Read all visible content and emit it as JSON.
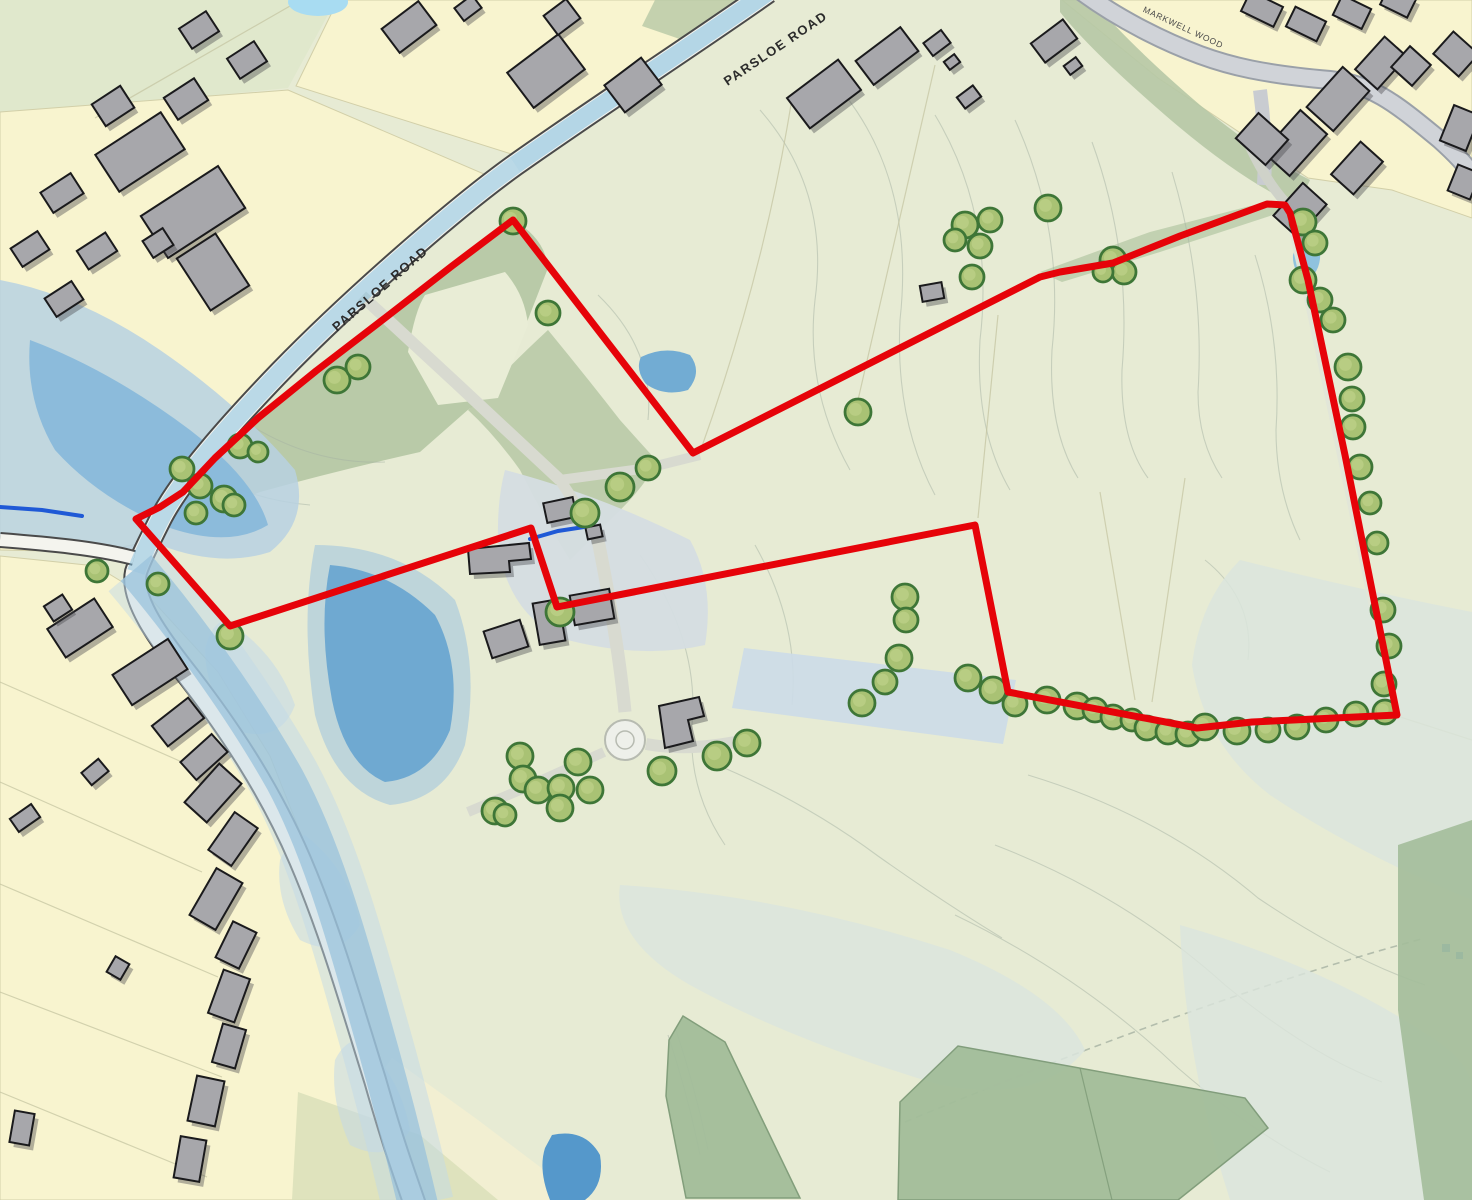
{
  "map": {
    "canvas": {
      "width": 1472,
      "height": 1200
    },
    "labels": [
      {
        "text": "PARSLOE ROAD",
        "x": 778,
        "y": 52,
        "rot": -34,
        "size": 13,
        "spacing": 1.5,
        "weight": 700,
        "color": "#2b2b2b"
      },
      {
        "text": "PARSLOE ROAD",
        "x": 383,
        "y": 292,
        "rot": -41,
        "size": 13,
        "spacing": 1.5,
        "weight": 700,
        "color": "#2b2b2b"
      },
      {
        "text": "MARKWELL WOOD",
        "x": 1182,
        "y": 30,
        "rot": 25,
        "size": 8.5,
        "spacing": 0.8,
        "weight": 400,
        "color": "#4a4a4a"
      }
    ],
    "site_boundary": {
      "color": "#e60309",
      "stroke_width": 7,
      "points": [
        [
          513,
          220
        ],
        [
          452,
          266
        ],
        [
          385,
          318
        ],
        [
          316,
          371
        ],
        [
          258,
          418
        ],
        [
          215,
          458
        ],
        [
          183,
          492
        ],
        [
          160,
          507
        ],
        [
          136,
          519
        ],
        [
          230,
          626
        ],
        [
          531,
          528
        ],
        [
          557,
          607
        ],
        [
          975,
          525
        ],
        [
          1008,
          692
        ],
        [
          1197,
          728
        ],
        [
          1252,
          722
        ],
        [
          1397,
          715
        ],
        [
          1345,
          455
        ],
        [
          1308,
          280
        ],
        [
          1290,
          213
        ],
        [
          1285,
          205
        ],
        [
          1267,
          204
        ],
        [
          1180,
          236
        ],
        [
          1113,
          263
        ],
        [
          1060,
          272
        ],
        [
          1040,
          277
        ],
        [
          693,
          453
        ]
      ]
    },
    "trees": {
      "fill": "#a9c274",
      "stroke": "#3e7637",
      "highlight": "#c8d892",
      "points": [
        [
          513,
          221,
          13
        ],
        [
          548,
          313,
          12
        ],
        [
          337,
          380,
          13
        ],
        [
          358,
          367,
          12
        ],
        [
          240,
          446,
          12
        ],
        [
          258,
          452,
          10
        ],
        [
          182,
          469,
          12
        ],
        [
          200,
          486,
          12
        ],
        [
          224,
          499,
          13
        ],
        [
          196,
          513,
          11
        ],
        [
          234,
          505,
          11
        ],
        [
          97,
          571,
          11
        ],
        [
          158,
          584,
          11
        ],
        [
          230,
          636,
          13
        ],
        [
          585,
          513,
          14
        ],
        [
          620,
          487,
          14
        ],
        [
          648,
          468,
          12
        ],
        [
          560,
          612,
          14
        ],
        [
          858,
          412,
          13
        ],
        [
          965,
          225,
          13
        ],
        [
          990,
          220,
          12
        ],
        [
          955,
          240,
          11
        ],
        [
          980,
          246,
          12
        ],
        [
          1048,
          208,
          13
        ],
        [
          972,
          277,
          12
        ],
        [
          1113,
          260,
          13
        ],
        [
          1124,
          272,
          12
        ],
        [
          1103,
          272,
          10
        ],
        [
          1303,
          222,
          13
        ],
        [
          1315,
          243,
          12
        ],
        [
          1303,
          280,
          13
        ],
        [
          1320,
          300,
          12
        ],
        [
          1333,
          320,
          12
        ],
        [
          1348,
          367,
          13
        ],
        [
          1352,
          399,
          12
        ],
        [
          1353,
          427,
          12
        ],
        [
          1360,
          467,
          12
        ],
        [
          1370,
          503,
          11
        ],
        [
          1377,
          543,
          11
        ],
        [
          1383,
          610,
          12
        ],
        [
          1389,
          646,
          12
        ],
        [
          1384,
          684,
          12
        ],
        [
          905,
          597,
          13
        ],
        [
          906,
          620,
          12
        ],
        [
          899,
          658,
          13
        ],
        [
          885,
          682,
          12
        ],
        [
          862,
          703,
          13
        ],
        [
          968,
          678,
          13
        ],
        [
          993,
          690,
          13
        ],
        [
          1015,
          704,
          12
        ],
        [
          1047,
          700,
          13
        ],
        [
          1077,
          706,
          13
        ],
        [
          1095,
          710,
          12
        ],
        [
          1113,
          717,
          12
        ],
        [
          1132,
          720,
          11
        ],
        [
          1147,
          728,
          12
        ],
        [
          1168,
          732,
          12
        ],
        [
          1188,
          734,
          12
        ],
        [
          1205,
          727,
          13
        ],
        [
          1237,
          731,
          13
        ],
        [
          1268,
          730,
          12
        ],
        [
          1297,
          727,
          12
        ],
        [
          1326,
          720,
          12
        ],
        [
          1356,
          714,
          12
        ],
        [
          1385,
          712,
          12
        ],
        [
          520,
          756,
          13
        ],
        [
          578,
          762,
          13
        ],
        [
          523,
          779,
          13
        ],
        [
          538,
          790,
          13
        ],
        [
          561,
          788,
          13
        ],
        [
          590,
          790,
          13
        ],
        [
          560,
          808,
          13
        ],
        [
          495,
          811,
          13
        ],
        [
          505,
          815,
          11
        ],
        [
          662,
          771,
          14
        ],
        [
          717,
          756,
          14
        ],
        [
          747,
          743,
          13
        ]
      ]
    },
    "buildings": {
      "fill": "#a7a7ab",
      "stroke": "#1a1a1c",
      "shadow": "rgba(70,70,75,0.40)",
      "rects": [
        [
          140,
          152,
          78,
          44,
          -33
        ],
        [
          193,
          212,
          92,
          50,
          -33
        ],
        [
          213,
          272,
          46,
          62,
          -33
        ],
        [
          113,
          106,
          34,
          26,
          -33
        ],
        [
          62,
          193,
          36,
          24,
          -33
        ],
        [
          30,
          249,
          32,
          22,
          -33
        ],
        [
          97,
          251,
          34,
          22,
          -33
        ],
        [
          64,
          299,
          32,
          22,
          -33
        ],
        [
          186,
          99,
          36,
          26,
          -33
        ],
        [
          247,
          60,
          32,
          24,
          -33
        ],
        [
          199,
          30,
          32,
          24,
          -33
        ],
        [
          158,
          243,
          24,
          20,
          -33
        ],
        [
          409,
          27,
          46,
          30,
          -37
        ],
        [
          546,
          71,
          64,
          44,
          -37
        ],
        [
          562,
          17,
          28,
          24,
          -37
        ],
        [
          633,
          85,
          46,
          34,
          -37
        ],
        [
          468,
          8,
          22,
          16,
          -37
        ],
        [
          824,
          94,
          64,
          38,
          -37
        ],
        [
          887,
          56,
          56,
          30,
          -37
        ],
        [
          937,
          43,
          22,
          16,
          -37
        ],
        [
          952,
          62,
          13,
          10,
          -37
        ],
        [
          969,
          97,
          20,
          14,
          -37
        ],
        [
          1054,
          41,
          40,
          24,
          -37
        ],
        [
          1073,
          66,
          15,
          11,
          -37
        ],
        [
          932,
          292,
          22,
          16,
          -10
        ],
        [
          1262,
          9,
          36,
          22,
          26
        ],
        [
          1306,
          24,
          34,
          22,
          26
        ],
        [
          1352,
          12,
          32,
          22,
          26
        ],
        [
          1398,
          2,
          30,
          20,
          26
        ],
        [
          1295,
          143,
          56,
          36,
          -48
        ],
        [
          1338,
          99,
          54,
          36,
          -48
        ],
        [
          1381,
          63,
          44,
          30,
          -48
        ],
        [
          1411,
          66,
          28,
          28,
          -48
        ],
        [
          1456,
          54,
          30,
          34,
          -48
        ],
        [
          1262,
          139,
          34,
          40,
          -48
        ],
        [
          1357,
          168,
          44,
          30,
          -48
        ],
        [
          1300,
          210,
          44,
          32,
          -48
        ],
        [
          1460,
          128,
          28,
          38,
          22
        ],
        [
          1464,
          182,
          24,
          28,
          22
        ],
        [
          80,
          628,
          56,
          34,
          -33
        ],
        [
          58,
          608,
          22,
          18,
          -33
        ],
        [
          150,
          672,
          66,
          36,
          -33
        ],
        [
          178,
          722,
          46,
          26,
          -38
        ],
        [
          204,
          757,
          42,
          24,
          -42
        ],
        [
          213,
          793,
          52,
          30,
          -48
        ],
        [
          233,
          839,
          46,
          28,
          -55
        ],
        [
          216,
          899,
          54,
          30,
          -60
        ],
        [
          236,
          945,
          40,
          26,
          -64
        ],
        [
          229,
          996,
          46,
          28,
          -70
        ],
        [
          229,
          1046,
          40,
          24,
          -74
        ],
        [
          206,
          1101,
          46,
          28,
          -78
        ],
        [
          190,
          1159,
          42,
          26,
          -80
        ],
        [
          95,
          772,
          22,
          16,
          -40
        ],
        [
          25,
          818,
          26,
          16,
          -35
        ],
        [
          118,
          968,
          18,
          16,
          -60
        ],
        [
          22,
          1128,
          32,
          20,
          -80
        ],
        [
          560,
          510,
          30,
          20,
          -12
        ],
        [
          594,
          532,
          15,
          12,
          -12
        ],
        [
          549,
          622,
          26,
          42,
          -10
        ],
        [
          592,
          607,
          40,
          30,
          -10
        ],
        [
          506,
          639,
          38,
          28,
          -18
        ]
      ],
      "polys": [
        [
          [
            468,
            549
          ],
          [
            529,
            543
          ],
          [
            531,
            559
          ],
          [
            509,
            561
          ],
          [
            510,
            572
          ],
          [
            470,
            574
          ]
        ],
        [
          [
            659,
            706
          ],
          [
            699,
            697
          ],
          [
            704,
            716
          ],
          [
            688,
            720
          ],
          [
            693,
            741
          ],
          [
            665,
            748
          ]
        ]
      ]
    },
    "streams": [
      [
        [
          530,
          539
        ],
        [
          558,
          531
        ],
        [
          584,
          527
        ]
      ],
      [
        [
          0,
          507
        ],
        [
          42,
          510
        ],
        [
          82,
          516
        ]
      ]
    ],
    "colors": {
      "field": "#e7ebd4",
      "parcel_yellow": "#f8f4cf",
      "flood_light": "#b7d1e2",
      "flood_mid": "#86b8da",
      "flood_dark": "#6fa9d1",
      "flood_pale": "#d5dde2",
      "teal_band": "#dbe5dd",
      "woodland": "#b6c8a5",
      "dark_field": "#a3bd9a",
      "road_fill": "#f4f4ee",
      "road_casing": "#4a4a4a",
      "track": "#d8dad0",
      "stream": "#1f59d6",
      "contour": "#a6b3a4"
    }
  }
}
